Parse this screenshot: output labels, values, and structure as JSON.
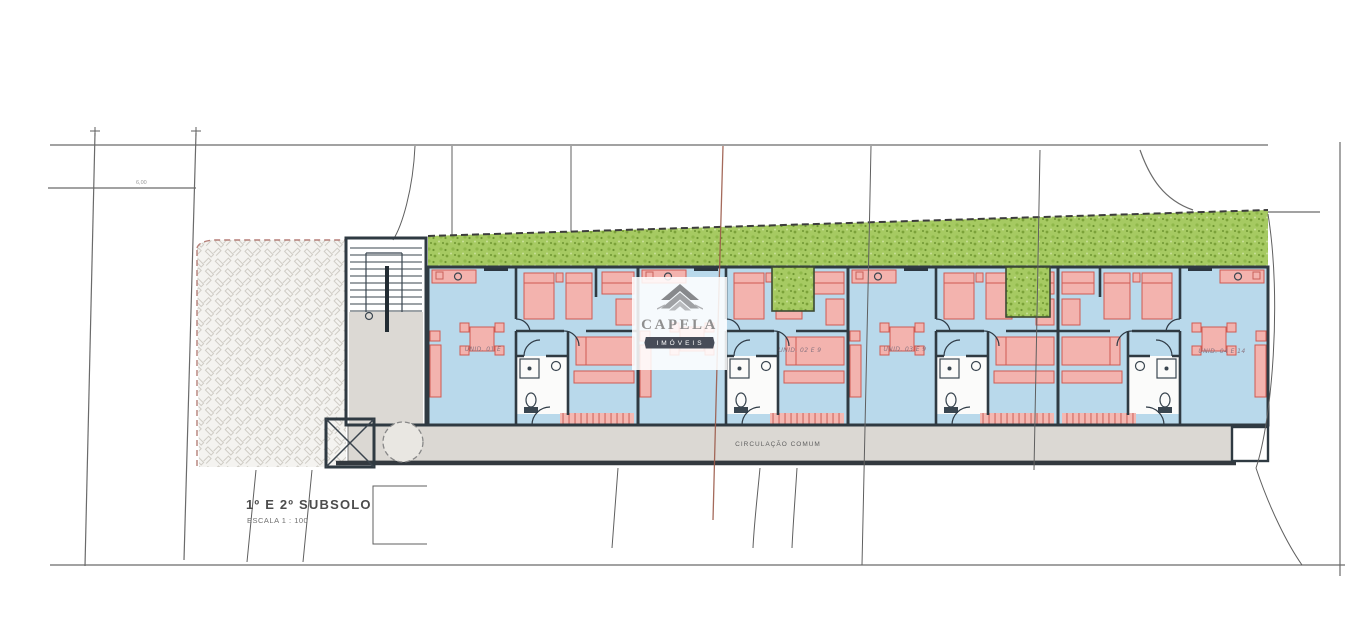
{
  "document": {
    "title": "1º E 2º SUBSOLO",
    "scale_label": "ESCALA 1 : 100"
  },
  "plan": {
    "corridor_label": "CIRCULAÇÃO COMUM",
    "dimension_note": "6,00",
    "units": [
      {
        "id": 1,
        "label": "UNID. 01 E"
      },
      {
        "id": 2,
        "label": "UNID. 02 E 9"
      },
      {
        "id": 3,
        "label": "UNID. 03 E 9"
      },
      {
        "id": 4,
        "label": "UNID. 04 E 14"
      }
    ]
  },
  "watermark": {
    "brand": "CAPELA",
    "tagline": "IMÓVEIS"
  },
  "colors": {
    "floor_blue": "#b9d9eb",
    "wall_dark": "#2f3a42",
    "furniture_red_fill": "#f3b3ae",
    "furniture_red_stroke": "#cf5a52",
    "landscape_green": "#a6ca62",
    "landscape_green_dark": "#7ba238",
    "paving_gray": "#f4f3f0",
    "paving_hatch": "#cfccc5",
    "corridor_gray": "#dbd8d3",
    "site_line": "#6a6a6a",
    "survey_red_line": "#9b5a49",
    "watermark_gray": "#8f8f8f",
    "ribbon_dark": "#474c58"
  }
}
